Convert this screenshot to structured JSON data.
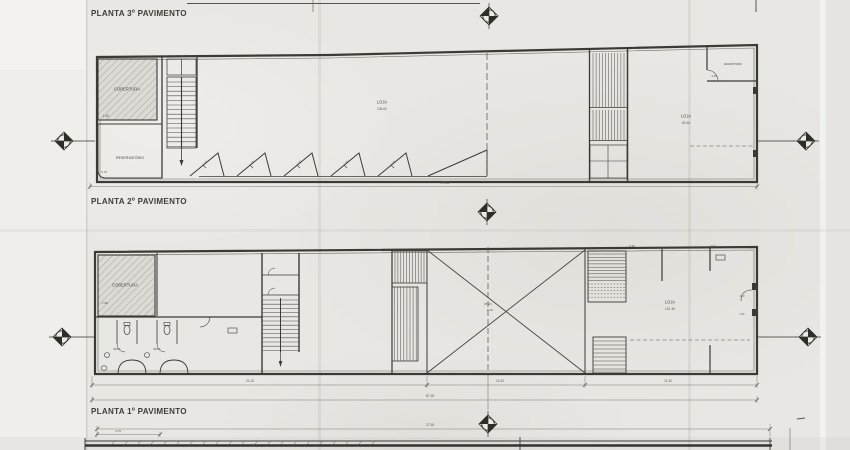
{
  "page": {
    "paper_color": "#e9e7e3",
    "ink_color": "#3b3a35"
  },
  "titles": {
    "floor3": "PLANTA 3º PAVIMENTO",
    "floor2": "PLANTA 2º PAVIMENTO",
    "floor1": "PLANTA 1º PAVIMENTO"
  },
  "floor2_plan": {
    "rooms": {
      "cobertura": "COBERTURA",
      "cobertura_dim": "1.80",
      "reservatorio": "RESERVATÓRIO",
      "reservatorio_dim": "5.70",
      "loja": "LOJA",
      "loja_area": "135.00",
      "loja_right": "LOJA",
      "loja_right_area": "82.46",
      "escritorio": "ESCRITÓRIO",
      "escritorio_dim": "3.00"
    },
    "sawtooth_labels": [
      "1.00",
      "1.00",
      "1.00",
      "1.00",
      "1.00"
    ],
    "dims": {
      "total_width": "27.35"
    }
  },
  "floor1_plan": {
    "rooms": {
      "cobertura": "COBERTURA",
      "cobertura_dim": "1.80",
      "sanit_a": "SANIT.",
      "sanit_b": "SANIT.",
      "loja": "LOJA",
      "loja_area": "191.36",
      "level_label": "PISO",
      "level_value": "0.00"
    },
    "dims": {
      "left_bay": "21.20",
      "center_bay": "14.30",
      "right_bay": "11.30",
      "total": "87.35",
      "top_a": "6.35",
      "top_b": "5.00",
      "side_a": "4.50",
      "side_b": "1.00"
    }
  },
  "ground_plan": {
    "dims": {
      "left": "4.75",
      "total": "27.35"
    }
  }
}
